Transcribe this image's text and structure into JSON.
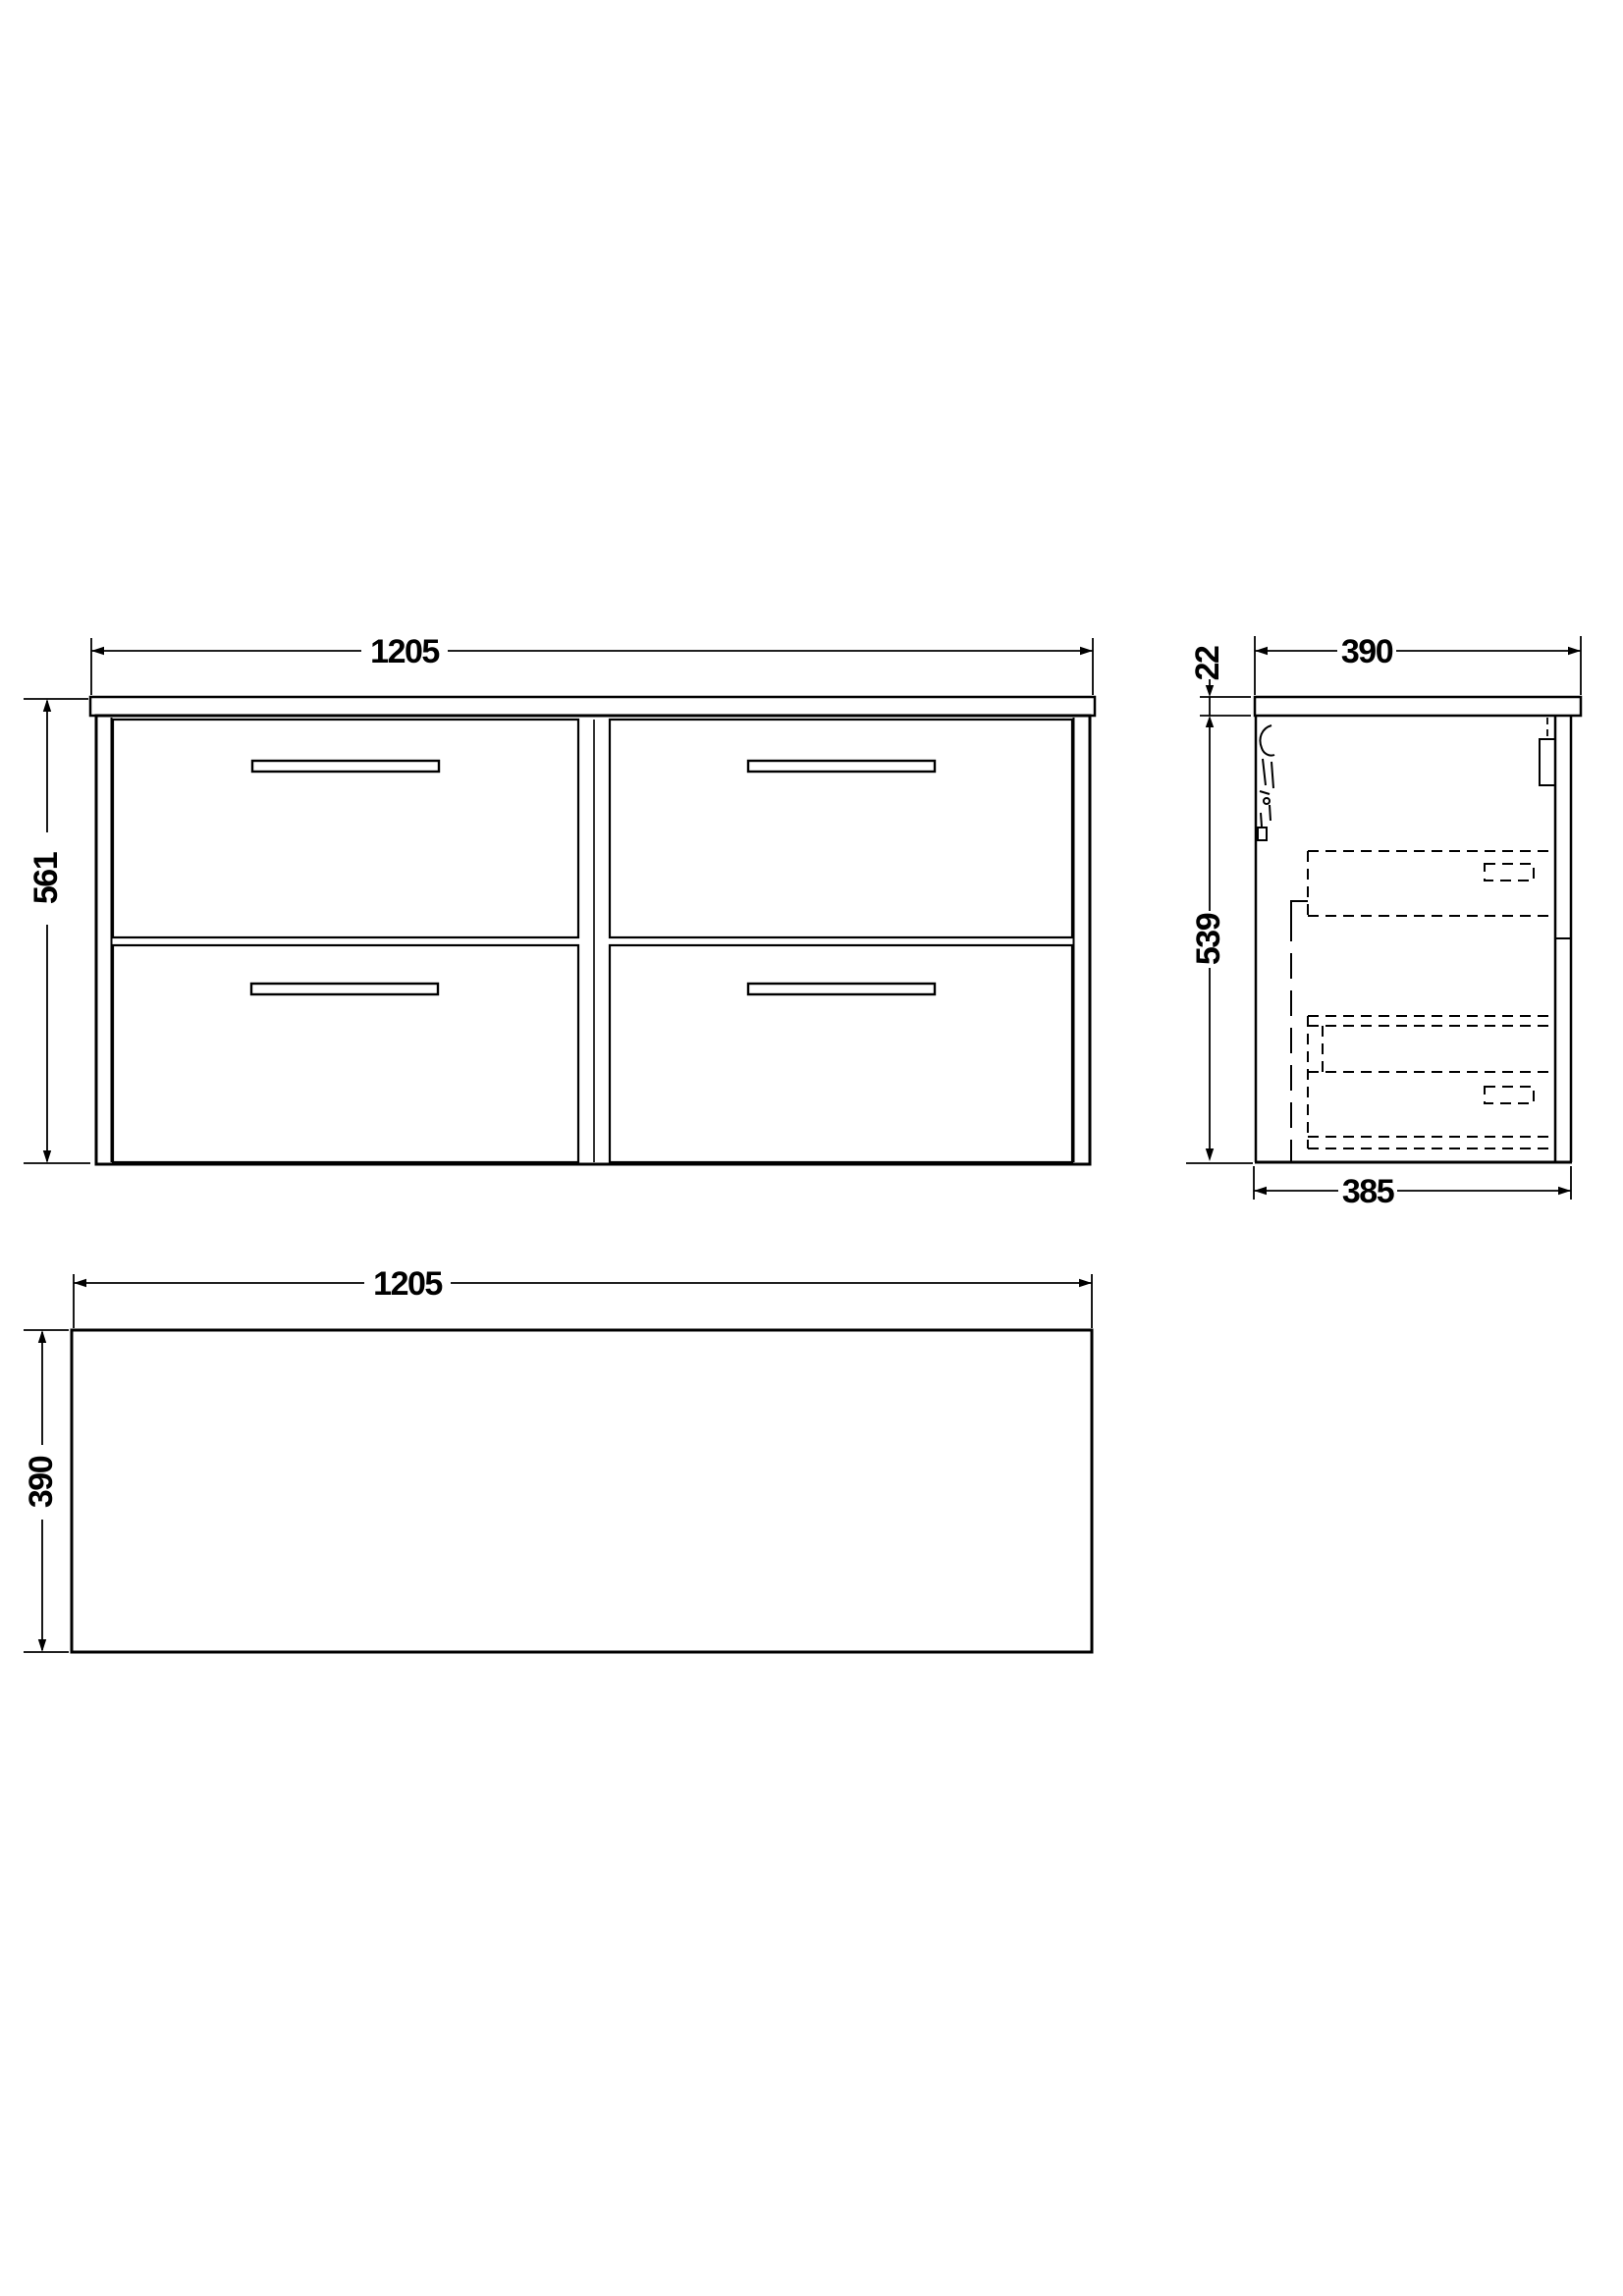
{
  "colors": {
    "line": "#000000",
    "background": "#ffffff"
  },
  "views": {
    "front": {
      "dim_width": "1205",
      "dim_height": "561"
    },
    "side": {
      "dim_depth_overall": "390",
      "dim_worktop_thickness": "22",
      "dim_body_height": "539",
      "dim_body_depth": "385"
    },
    "plan": {
      "dim_width": "1205",
      "dim_depth": "390"
    }
  }
}
